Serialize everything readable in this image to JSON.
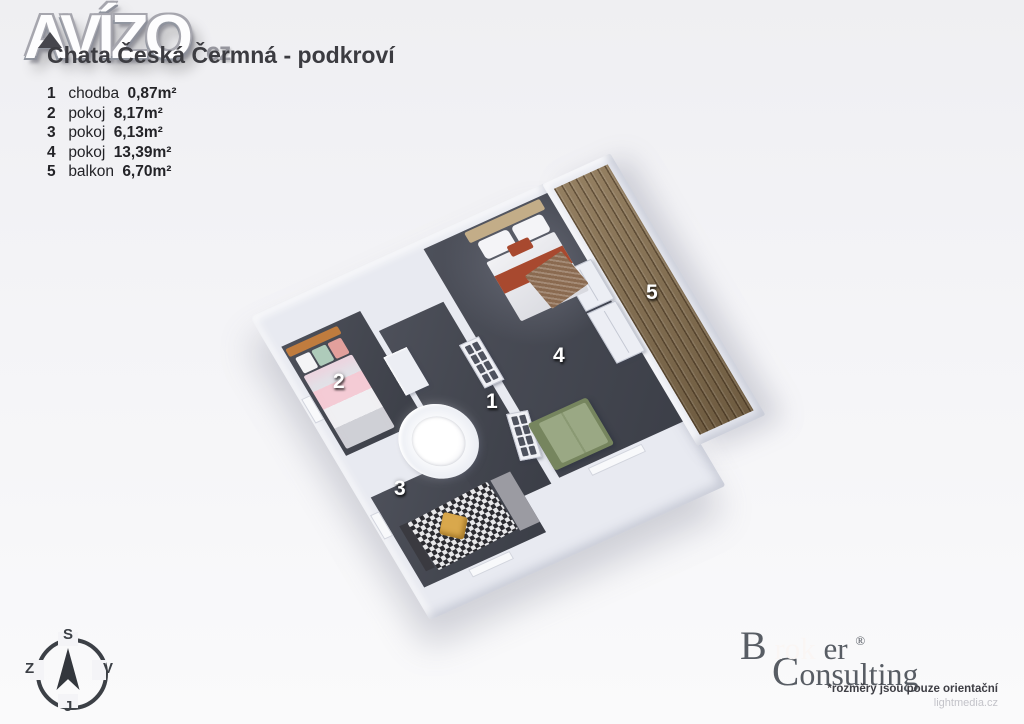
{
  "branding": {
    "avizo": {
      "text": "AVÍZO",
      "tld": "cz"
    },
    "broker": {
      "word1_parts": [
        "B",
        "rok",
        "er"
      ],
      "registered": "®",
      "word2": "Consulting",
      "accent_color": "#d5655c"
    },
    "disclaimer": "*rozměry jsou pouze orientační",
    "credit": "lightmedia.cz"
  },
  "header": {
    "title": "Chata Česká Čermná - podkroví"
  },
  "legend": {
    "items": [
      {
        "number": "1",
        "name": "chodba",
        "area": "0,87m²"
      },
      {
        "number": "2",
        "name": "pokoj",
        "area": "8,17m²"
      },
      {
        "number": "3",
        "name": "pokoj",
        "area": "6,13m²"
      },
      {
        "number": "4",
        "name": "pokoj",
        "area": "13,39m²"
      },
      {
        "number": "5",
        "name": "balkon",
        "area": "6,70m²"
      }
    ]
  },
  "floorplan": {
    "labels": {
      "hall": "1",
      "bedroom2": "2",
      "bedroom3": "3",
      "bedroom4": "4",
      "balcony": "5"
    },
    "colors": {
      "floor": "#43464f",
      "wall": "#e8eaf1",
      "balcony_wood": "#87704f",
      "bed2_accent": "#f4cbd5",
      "bed3_pillow": "#d9a84c",
      "bed4_accent": "#a8492f",
      "sofa": "#9aa884"
    }
  },
  "compass": {
    "north": "S",
    "east": "V",
    "south": "J",
    "west": "Z"
  }
}
